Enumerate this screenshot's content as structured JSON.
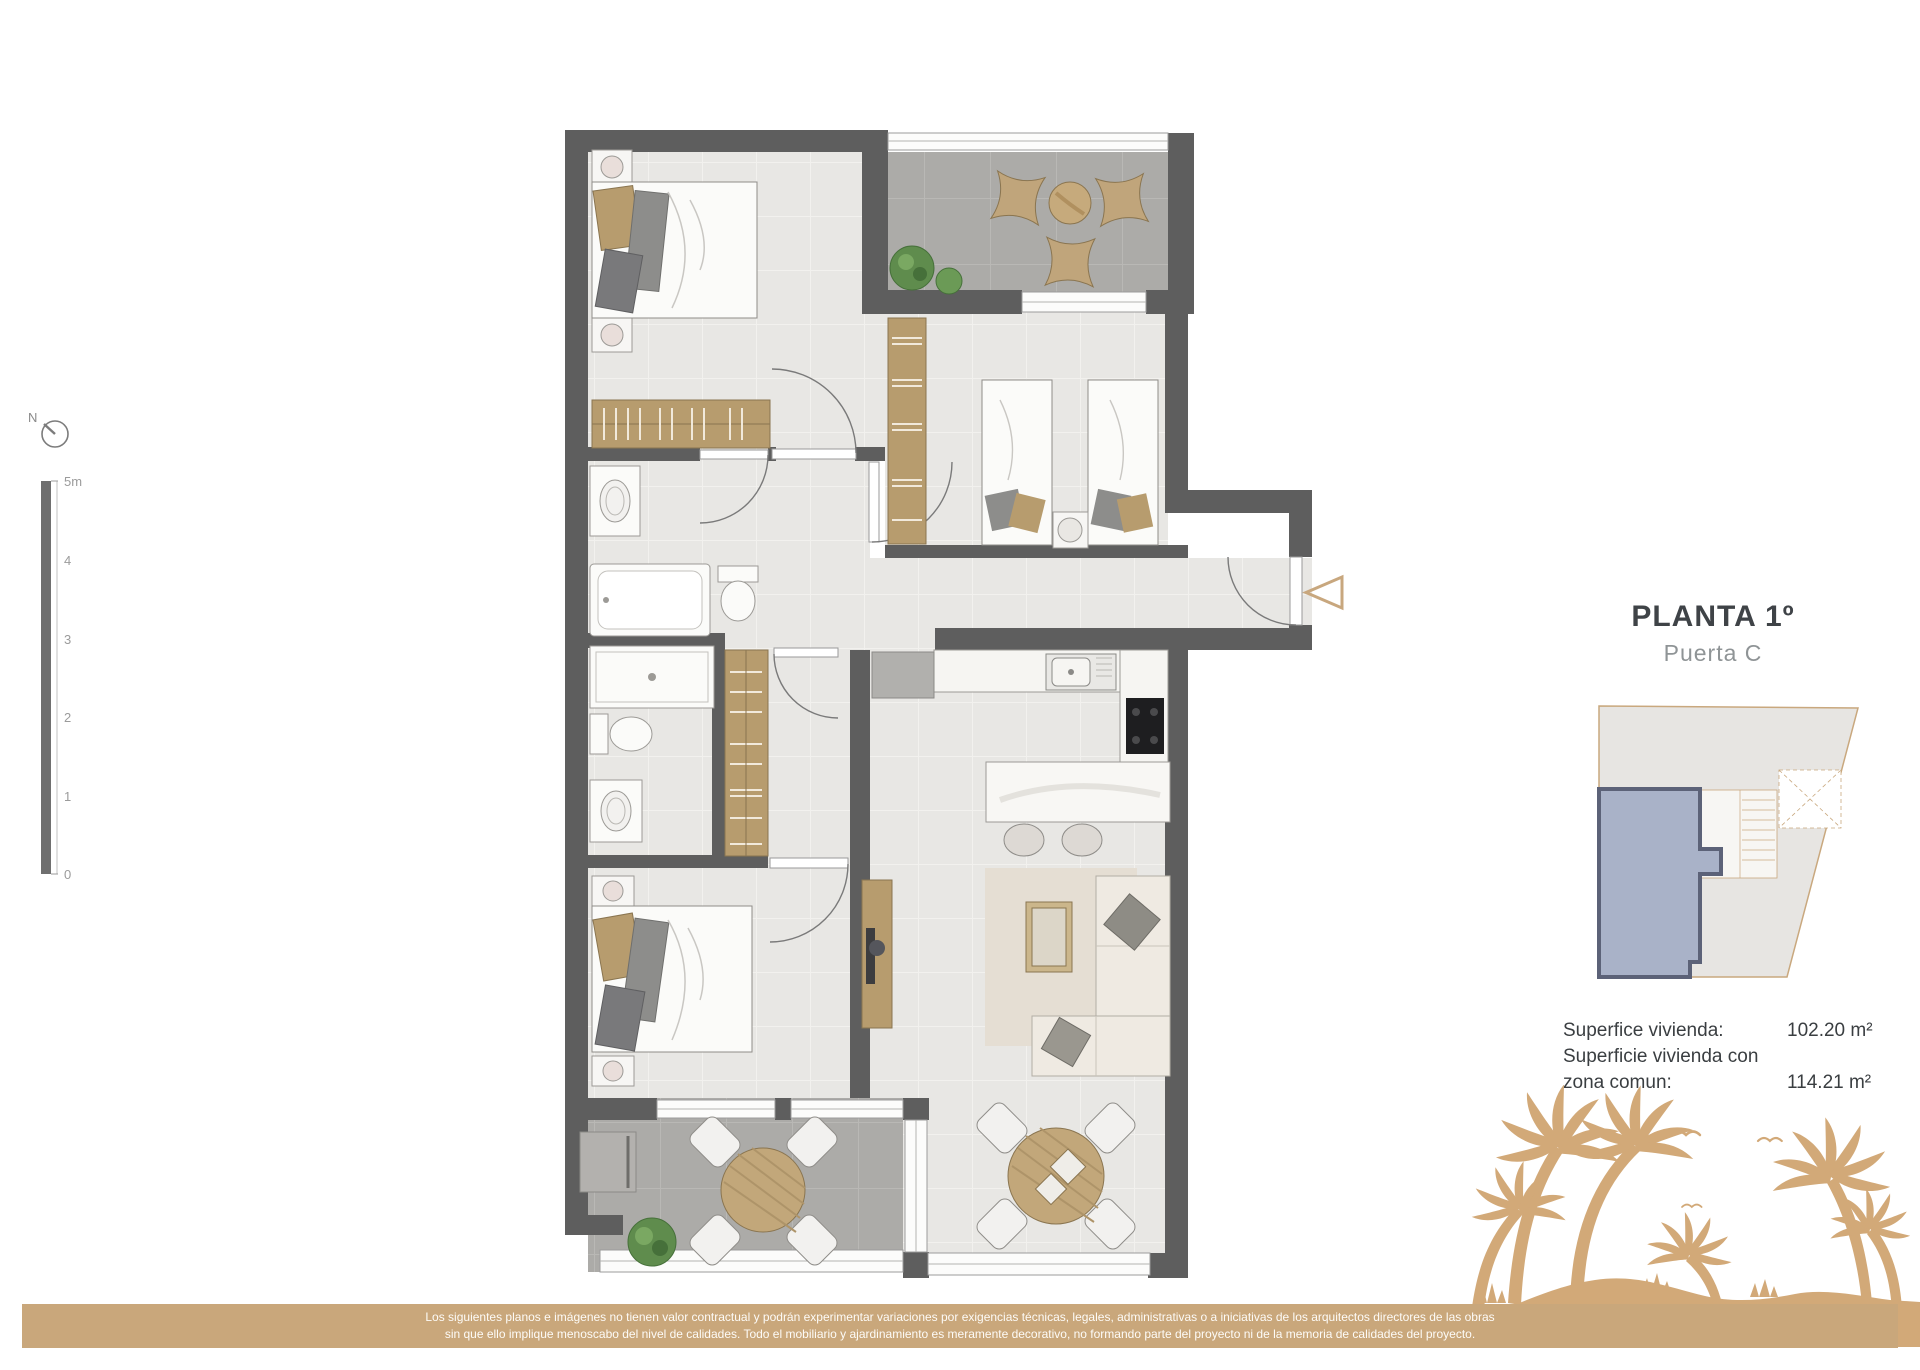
{
  "title_block": {
    "title": "PLANTA 1º",
    "subtitle": "Puerta C"
  },
  "areas": {
    "row1_label": "Superfice vivienda:",
    "row1_value": "102.20 m²",
    "row2_label": "Superficie vivienda con",
    "row3_label": "zona comun:",
    "row3_value": "114.21 m²"
  },
  "compass": {
    "label": "N"
  },
  "scale_bar": {
    "labels": [
      "5m",
      "4",
      "3",
      "2",
      "1",
      "0"
    ]
  },
  "disclaimer": {
    "line1": "Los siguientes planos e imágenes no tienen valor contractual y podrán experimentar variaciones por exigencias técnicas, legales, administrativas o a iniciativas de los arquitectos directores de las obras",
    "line2": "sin que ello implique menoscabo del nivel de calidades. Todo el mobiliario y ajardinamiento es meramente decorativo, no formando parte del proyecto ni de la memoria de calidades del proyecto."
  },
  "colors": {
    "accent_tan": "#D2A978",
    "bar_tan": "#C9A77B",
    "wall_gray": "#5E5E5E",
    "floor_light": "#E8E7E4",
    "floor_terrace": "#ACABA8",
    "wood_tan": "#B79C6E",
    "unit_fill": "#A9B2C8",
    "unit_stroke": "#5C6278",
    "site_outline": "#C9A87E"
  }
}
